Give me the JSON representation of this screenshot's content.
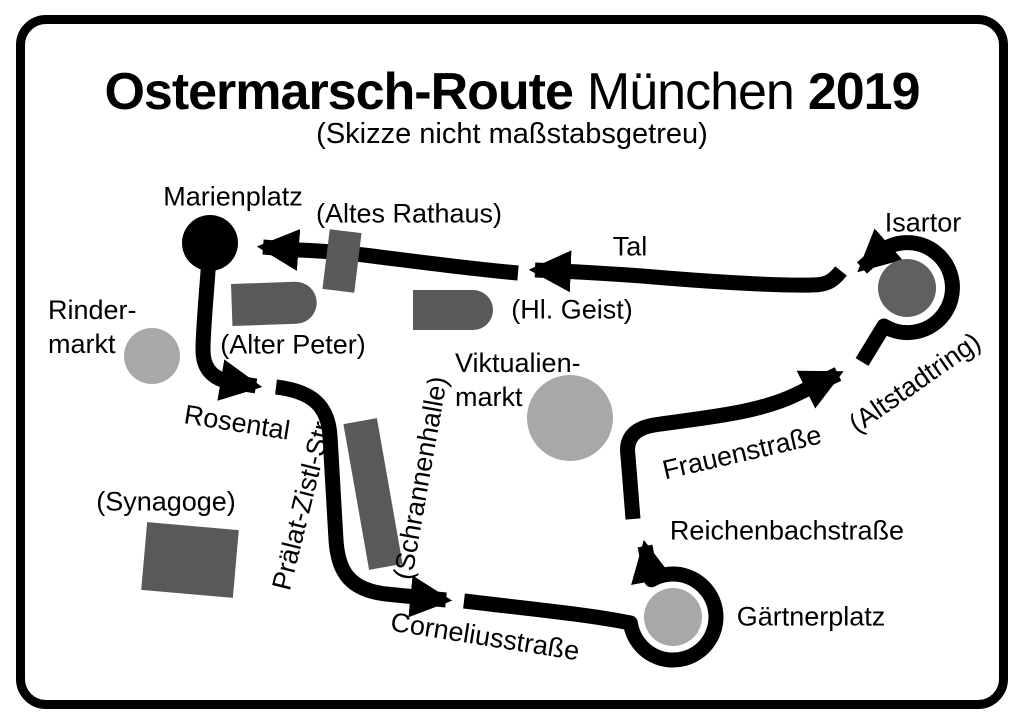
{
  "title": {
    "part1": "Ostermarsch-Route",
    "part2": "München",
    "part3": "2019",
    "subtitle": "(Skizze nicht maßstabsgetreu)"
  },
  "places": {
    "marienplatz": "Marienplatz",
    "rindermarkt_line1": "Rinder-",
    "rindermarkt_line2": "markt",
    "viktualienmarkt_line1": "Viktualien-",
    "viktualienmarkt_line2": "markt",
    "gaertnerplatz": "Gärtnerplatz",
    "isartor": "Isartor"
  },
  "buildings": {
    "altes_rathaus": "(Altes Rathaus)",
    "alter_peter": "(Alter Peter)",
    "hl_geist": "(Hl. Geist)",
    "schrannenhalle": "(Schrannenhalle)",
    "synagoge": "(Synagoge)"
  },
  "streets": {
    "tal": "Tal",
    "rosental": "Rosental",
    "praelat_zistl_str": "Prälat-Zistl-Str.",
    "corneliusstrasse": "Corneliusstraße",
    "reichenbachstrasse": "Reichenbachstraße",
    "frauenstrasse": "Frauenstraße",
    "altstadtring": "(Altstadtring)"
  },
  "colors": {
    "route": "#000000",
    "building_gray": "#595959",
    "isartor_gray": "#606060",
    "place_gray": "#a8a8a8",
    "background": "#ffffff",
    "border": "#000000"
  }
}
